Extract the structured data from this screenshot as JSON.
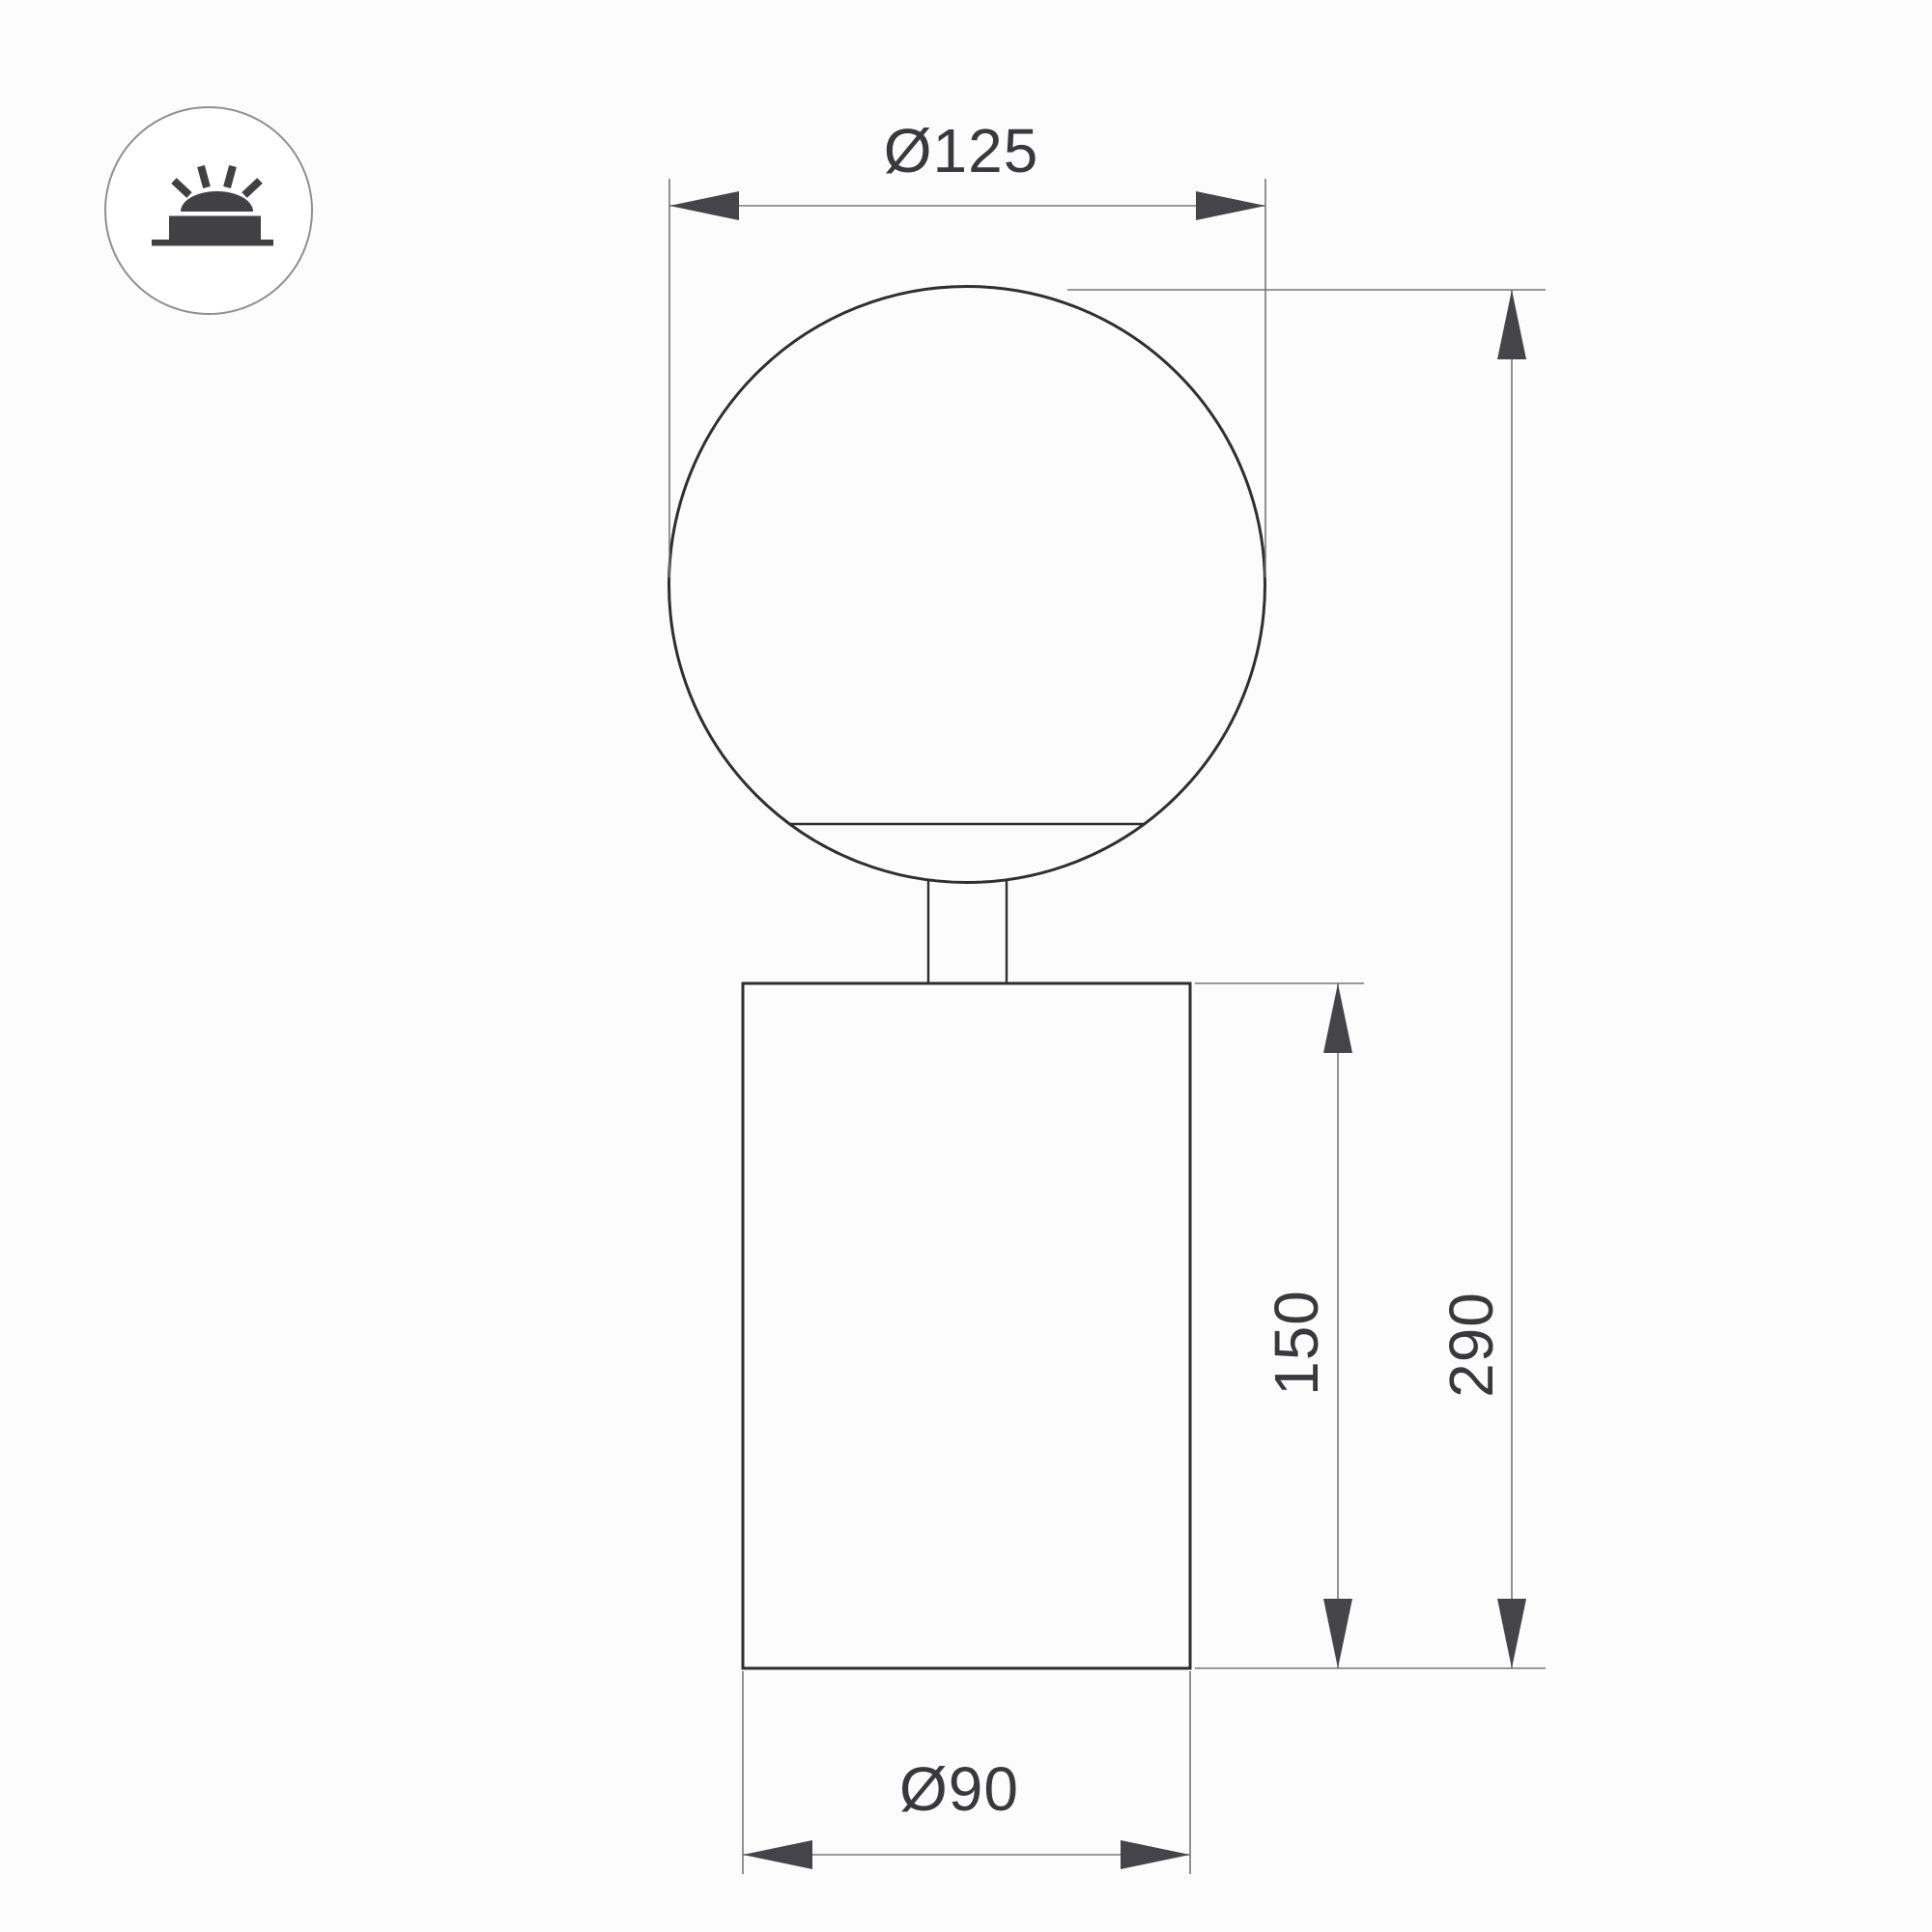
{
  "drawing": {
    "type": "technical-dimension-drawing",
    "subject": "globe table luminaire (sphere on cylindrical base)",
    "dimensions": {
      "globe_diameter": "Ø125",
      "overall_height": "290",
      "body_height": "150",
      "body_diameter": "Ø90"
    }
  },
  "icons": {
    "badge": "surface-mounted-light-icon"
  },
  "colors": {
    "outline": "#2f2f31",
    "dim-line": "#77777a",
    "arrow": "#454547",
    "text": "#39393b",
    "icon-glyph": "#414143",
    "icon-ring": "#8f8f91",
    "background": "#fcfcfc"
  }
}
